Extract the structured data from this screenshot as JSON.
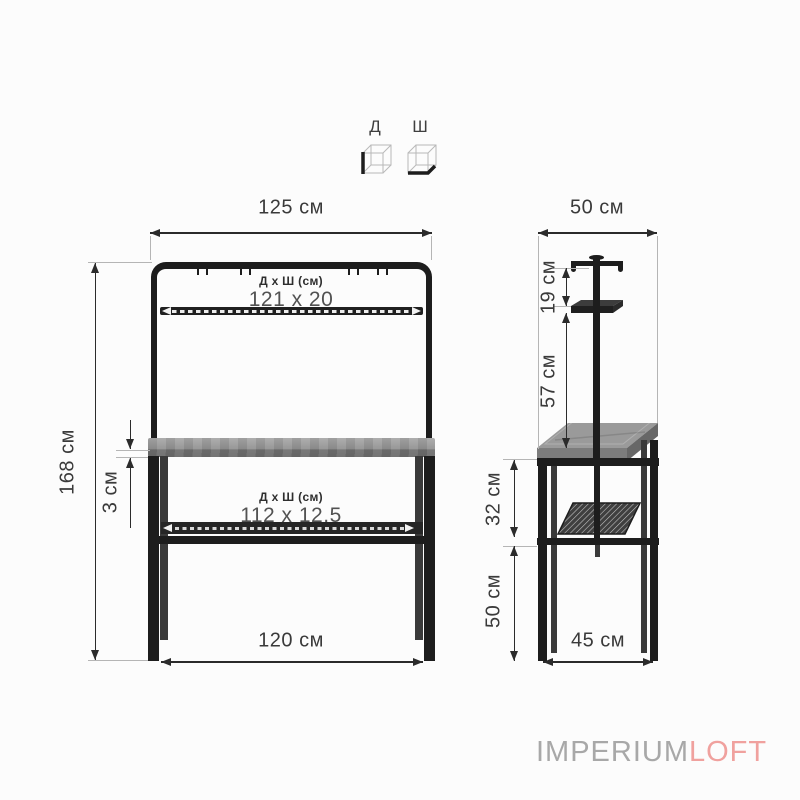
{
  "legend": {
    "length_label": "Д",
    "width_label": "Ш"
  },
  "front_view": {
    "top_width": "125 см",
    "height": "168 см",
    "rail_spec_title": "Д х Ш (см)",
    "rail_spec_value": "121 x 20",
    "tabletop_thickness": "3 см",
    "shelf_spec_title": "Д х Ш (см)",
    "shelf_spec_value": "112 x 12,5",
    "bottom_width": "120 см"
  },
  "side_view": {
    "top_depth": "50 см",
    "hanger_offset": "19 см",
    "rack_to_table": "57 см",
    "table_to_shelf": "32 см",
    "shelf_to_floor": "50 см",
    "bottom_depth": "45 см"
  },
  "brand": {
    "gray_part": "IMPERIUM",
    "accent_part": "LOFT"
  },
  "colors": {
    "line": "#2b2b2b",
    "structure": "#1d1d1d",
    "wood": "#909090",
    "brand_gray": "#a8a8a8",
    "brand_pink": "#f0a19e"
  }
}
